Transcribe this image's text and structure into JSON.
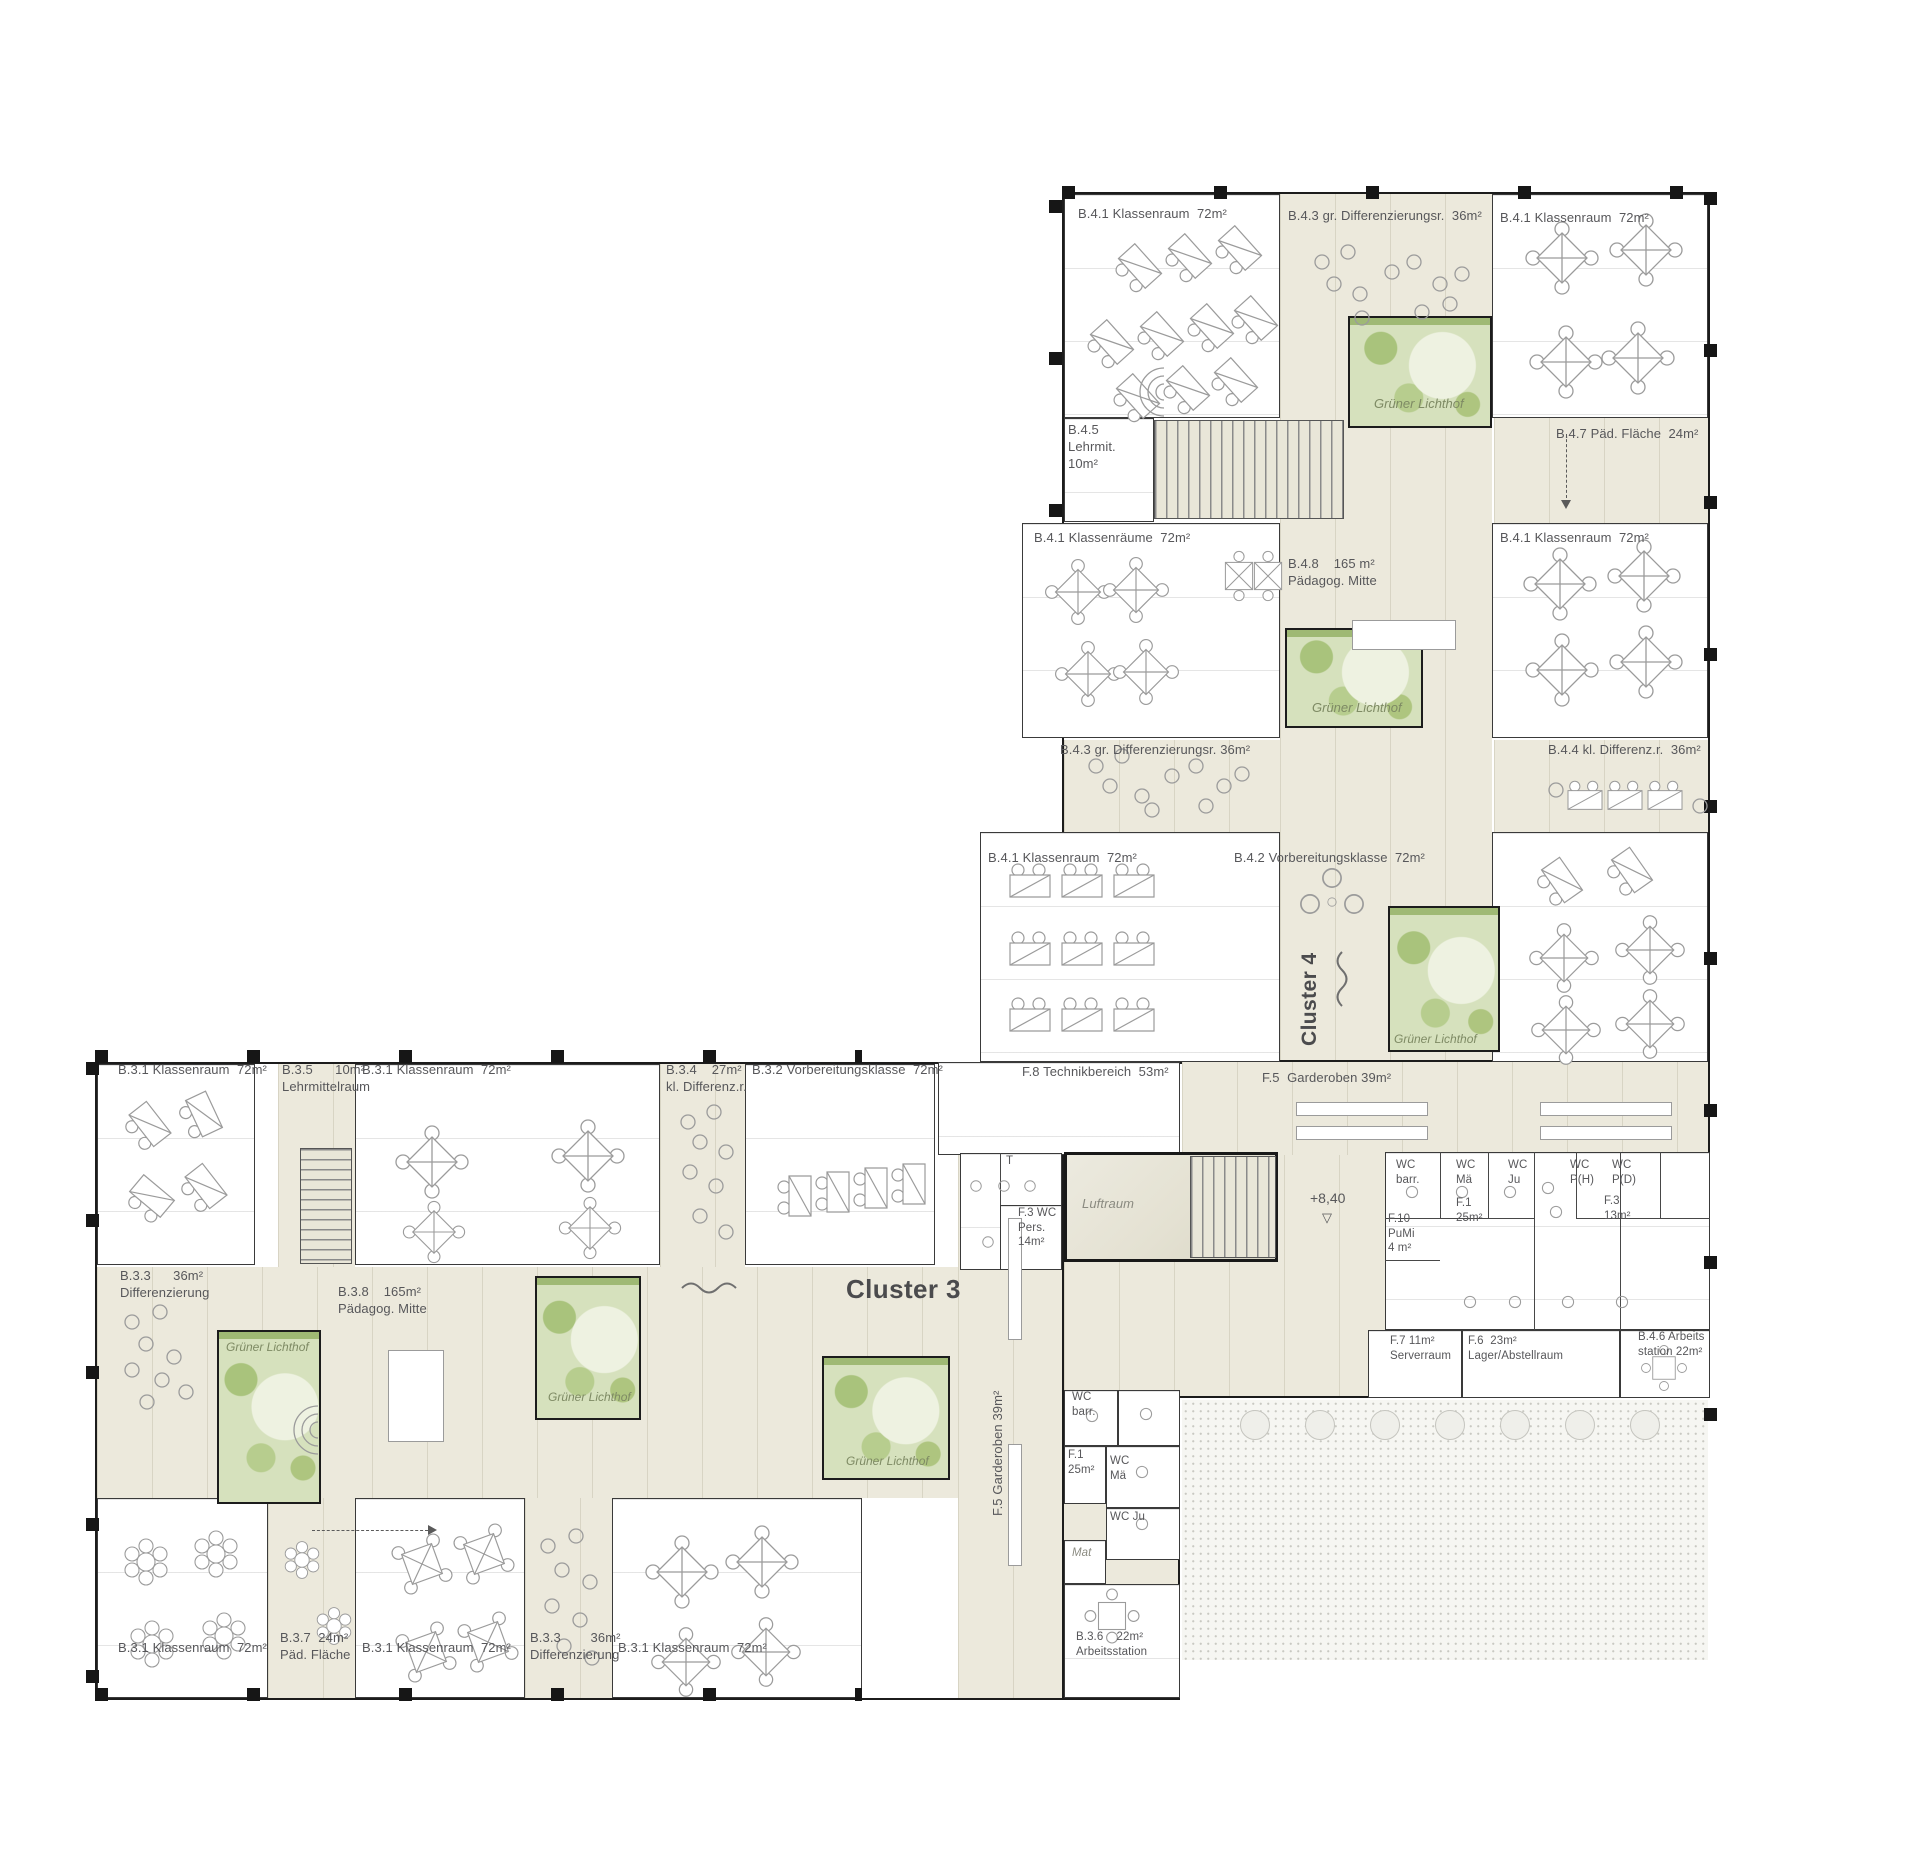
{
  "clusters": {
    "c3": "Cluster 3",
    "c4": "Cluster 4"
  },
  "courtyard_label": "Grüner Lichthof",
  "level_marker": "+8,40",
  "level_symbol": "▽",
  "misc": {
    "t": "T",
    "luftraum": "Luftraum",
    "mat": "Mat"
  },
  "rooms_c4": {
    "kr_top_left": "B.4.1 Klassenraum  72m²",
    "diff_top": "B.4.3 gr. Differenzierungsr.  36m²",
    "kr_top_right": "B.4.1 Klassenraum  72m²",
    "lehrmittel": [
      "B.4.5",
      "Lehrmit.",
      "10m²"
    ],
    "paed_flaeche": "B.4.7 Päd. Fläche  24m²",
    "kr_mid_left": "B.4.1 Klassenräume  72m²",
    "paedagog_mitte": [
      "B.4.8    165 m²",
      "Pädagog. Mitte"
    ],
    "kr_mid_right": "B.4.1 Klassenraum  72m²",
    "diff_gross": "B.4.3 gr. Differenzierungsr. 36m²",
    "diff_klein": "B.4.4 kl. Differenz.r.  36m²",
    "kr_bottom_left": "B.4.1 Klassenraum  72m²",
    "vorbereitungsklasse": "B.4.2 Vorbereitungsklasse  72m²",
    "arbeitsstation": [
      "B.4.6 Arbeits",
      "station 22m²"
    ]
  },
  "rooms_c3": {
    "kr_top_left": "B.3.1 Klassenraum  72m²",
    "lehrmittelraum": [
      "B.3.5      10m²",
      "Lehrmittelraum"
    ],
    "kr_top_mid": "B.3.1 Klassenraum  72m²",
    "diff_klein": [
      "B.3.4    27m²",
      "kl. Differenz.r."
    ],
    "vorbereitungsklasse": "B.3.2 Vorbereitungsklasse  72m²",
    "diff_top": [
      "B.3.3      36m²",
      "Differenzierung"
    ],
    "paedagog_mitte": [
      "B.3.8    165m²",
      "Pädagog. Mitte"
    ],
    "paed_flaeche": [
      "B.3.7  24m²",
      "Päd. Fläche"
    ],
    "kr_bottom_left": "B.3.1 Klassenraum  72m²",
    "kr_bottom_mid": "B.3.1 Klassenraum  72m²",
    "diff_bottom": [
      "B.3.3        36m²",
      "Differenzierung"
    ],
    "kr_bottom_right": "B.3.1 Klassenraum  72m²",
    "arbeitsstation": [
      "B.3.6    22m²",
      "Arbeitsstation"
    ]
  },
  "service": {
    "technik": "F.8 Technikbereich  53m²",
    "garderoben_top": "F.5  Garderoben 39m²",
    "garderoben_vert": "F.5  Garderoben 39m²",
    "wc_pers": [
      "F.3 WC",
      "Pers.",
      "14m²"
    ],
    "wc_barr_r": [
      "WC",
      "barr."
    ],
    "wc_mae_r": [
      "WC",
      "Mä"
    ],
    "wc_ju_r": [
      "WC",
      "Ju"
    ],
    "wc_ph": [
      "WC",
      "P(H)"
    ],
    "wc_pd": [
      "WC",
      "P(D)"
    ],
    "f1_r": [
      "F.1",
      "25m²"
    ],
    "f3_r": [
      "F.3",
      "13m²"
    ],
    "f10_pumi": [
      "F.10",
      "PuMi",
      "4 m²"
    ],
    "f7_server": [
      "F.7 11m²",
      "Serverraum"
    ],
    "f6_lager": [
      "F.6  23m²",
      "Lager/Abstellraum"
    ],
    "wc_barr_b": [
      "WC",
      "barr."
    ],
    "f1_b": [
      "F.1",
      "25m²"
    ],
    "wc_mae_b": [
      "WC",
      "Mä"
    ],
    "wc_ju_b": "WC Ju"
  },
  "colors": {
    "wall": "#1c1c1c",
    "circulation_beige": "#ece9dc",
    "courtyard_green": "#d6e1bd",
    "plant_green": "#a9c37c",
    "furniture_gray": "#9b9b9b",
    "text_gray": "#57575a"
  }
}
